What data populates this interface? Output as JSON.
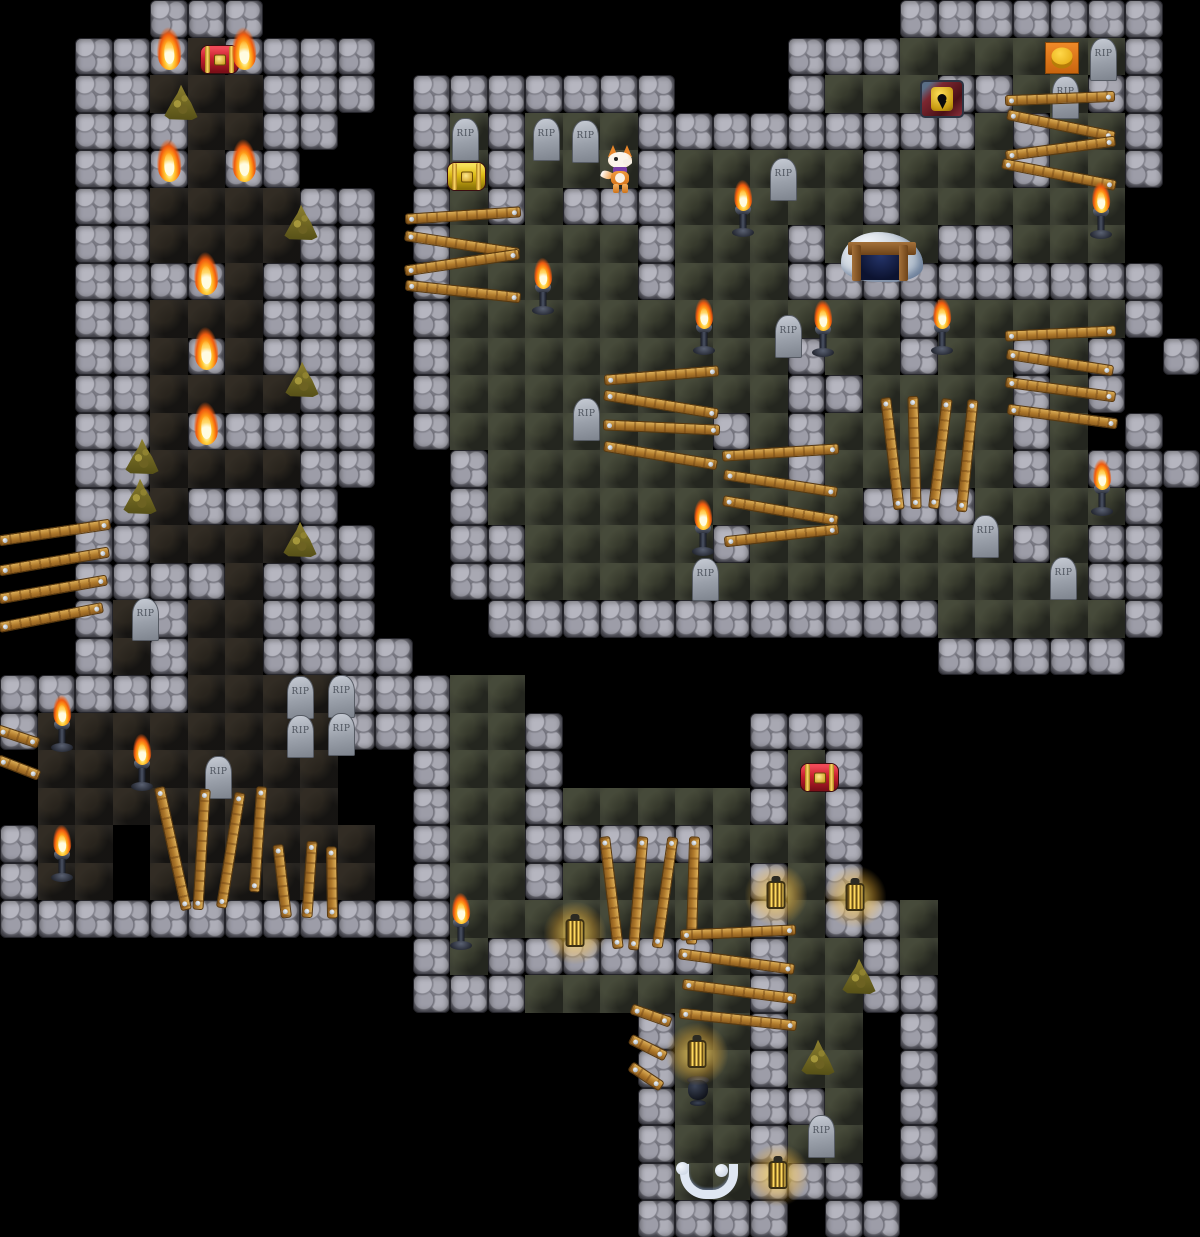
{
  "game": {
    "tile_size": 37.5,
    "grid_cols": 32,
    "grid_rows": 33,
    "labels": {
      "gravestone_text": "RIP"
    },
    "colors": {
      "background": "#000000",
      "stone_light": "#b6b6c0",
      "stone_dark": "#5a5a64",
      "floor_dark": "#272420",
      "floor_olive": "#3c3f33",
      "wood": "#b07a2c",
      "flame_orange": "#ff9a18",
      "gold": "#ffd84a",
      "chest_red": "#c81f2e",
      "chest_yellow": "#ddbb16",
      "lantern_glow": "#ffd65c"
    },
    "legend": {
      ".": "void",
      "#": "stone-wall",
      "a": "floor-dark",
      "b": "floor-olive",
      "T": "stone-wall-with-torch"
    },
    "map_rows": [
      "....###.................#######.",
      "..##TaT###...........###bbbbbb#.",
      "..##aaa###.#######...#bbb##bb##.",
      "..###aa##..#b#bbb#########b#bb#.",
      "..##TaT#...#b#bbb#bbbbb#bbb#bb#.",
      "..##aaaa##.#b#b###bbbbb#bbbbbb..",
      "..##aaaa##.#bbbbb#bbb#bbb##bbb..",
      "..###Ta###.#bbbbb#bbb##########.",
      "..##aaa###.#bbbbbbbbbbbb#bbbbb#.",
      "..##aTa###.#bbbbbbbbb#bb#bb#b#.#",
      "..##aaaa##.#bbbbbbbbb##bbbb#b#..",
      "..##aT####.#bbbbbbb#b#bbbbb#b.#.",
      "..##aaaa##..#bbbbbbbb#bbbbb#b###",
      "..##a####...#bbbbbbbbbb###bbbb#.",
      "..##aaaa##..##bbbbb#bbbbbbb#b##.",
      "..####a###..##bbbbbbbbbbbbbbb##.",
      "..#a#aa###...############bbbbb#.",
      "..#a#aa####..............#####..",
      "#####aaaa###bb..................",
      "#aaaaaaaa###bb#.....###.........",
      ".aaaaaaaa..#bb#.....#b#.........",
      ".aaaaaaaa..#bb#bbbbb#b#.........",
      "#aa.aaaaaa.#bb#####bbb#.........",
      "#aa.aaaaaa.#bb#bbbbb#b#.........",
      "############bbbbbbbb#b##b.......",
      "...........#b######b#bb#b.......",
      "...........###bbbbbb#bb##.......",
      ".................#bb#bb.#.......",
      ".................#bb#bb.#.......",
      ".................#bb##b.#.......",
      ".................#bb#bb.#.......",
      ".................#bb###.#.......",
      ".................####.##........"
    ],
    "objects": {
      "standing_torches": [
        [
          543,
          257
        ],
        [
          743,
          179
        ],
        [
          1101,
          181
        ],
        [
          1102,
          458
        ],
        [
          704,
          297
        ],
        [
          942,
          297
        ],
        [
          823,
          299
        ],
        [
          62,
          694
        ],
        [
          142,
          733
        ],
        [
          62,
          824
        ],
        [
          461,
          892
        ],
        [
          703,
          498
        ]
      ],
      "lanterns": [
        [
          565,
          918
        ],
        [
          766,
          880
        ],
        [
          845,
          882
        ],
        [
          687,
          1039
        ],
        [
          768,
          1160
        ]
      ],
      "urn": [
        686,
        1076
      ],
      "gold_piles": [
        [
          163,
          84
        ],
        [
          283,
          204
        ],
        [
          124,
          438
        ],
        [
          122,
          478
        ],
        [
          282,
          521
        ],
        [
          284,
          361
        ],
        [
          841,
          958
        ],
        [
          800,
          1039
        ]
      ],
      "gravestones": [
        [
          452,
          118
        ],
        [
          533,
          118
        ],
        [
          572,
          120
        ],
        [
          770,
          158
        ],
        [
          1090,
          38
        ],
        [
          1052,
          76
        ],
        [
          775,
          315
        ],
        [
          573,
          398
        ],
        [
          692,
          558
        ],
        [
          972,
          515
        ],
        [
          1050,
          557
        ],
        [
          132,
          598
        ],
        [
          287,
          676
        ],
        [
          328,
          675
        ],
        [
          287,
          715
        ],
        [
          328,
          713
        ],
        [
          205,
          756
        ],
        [
          808,
          1115
        ]
      ],
      "big_gravestone_index": 16,
      "red_chests": [
        [
          200,
          45
        ],
        [
          800,
          763
        ]
      ],
      "yellow_chests": [
        [
          447,
          162
        ]
      ],
      "door_lock": [
        920,
        80
      ],
      "pressure_pad": [
        1045,
        42
      ],
      "cave_entrance": [
        841,
        232
      ],
      "character": [
        605,
        145
      ],
      "bones": [
        676,
        1164
      ],
      "planks": [
        [
          408,
          219,
          518,
          212
        ],
        [
          408,
          236,
          517,
          253
        ],
        [
          408,
          270,
          517,
          254
        ],
        [
          408,
          285,
          517,
          297
        ],
        [
          1008,
          100,
          1112,
          96
        ],
        [
          1010,
          115,
          1112,
          136
        ],
        [
          1008,
          155,
          1112,
          141
        ],
        [
          1005,
          164,
          1113,
          185
        ],
        [
          607,
          380,
          716,
          371
        ],
        [
          607,
          395,
          716,
          413
        ],
        [
          606,
          425,
          717,
          430
        ],
        [
          607,
          446,
          715,
          464
        ],
        [
          725,
          456,
          836,
          449
        ],
        [
          727,
          475,
          835,
          492
        ],
        [
          726,
          501,
          835,
          520
        ],
        [
          727,
          541,
          835,
          529
        ],
        [
          886,
          400,
          899,
          506
        ],
        [
          913,
          399,
          916,
          506
        ],
        [
          947,
          401,
          934,
          505
        ],
        [
          973,
          402,
          962,
          508
        ],
        [
          1008,
          336,
          1113,
          331
        ],
        [
          1010,
          354,
          1111,
          370
        ],
        [
          1008,
          382,
          1112,
          396
        ],
        [
          1010,
          409,
          1114,
          423
        ],
        [
          160,
          790,
          186,
          907
        ],
        [
          205,
          792,
          198,
          907
        ],
        [
          240,
          795,
          222,
          905
        ],
        [
          262,
          789,
          255,
          889
        ],
        [
          278,
          847,
          286,
          915
        ],
        [
          312,
          844,
          307,
          915
        ],
        [
          332,
          849,
          333,
          915
        ],
        [
          605,
          839,
          618,
          945
        ],
        [
          643,
          839,
          634,
          947
        ],
        [
          673,
          840,
          658,
          945
        ],
        [
          695,
          839,
          692,
          941
        ],
        [
          683,
          935,
          793,
          930
        ],
        [
          682,
          954,
          792,
          969
        ],
        [
          685,
          984,
          793,
          998
        ],
        [
          682,
          1013,
          793,
          1025
        ],
        [
          634,
          1009,
          668,
          1021
        ],
        [
          633,
          1040,
          663,
          1055
        ],
        [
          633,
          1067,
          660,
          1085
        ],
        [
          2,
          540,
          108,
          524
        ],
        [
          2,
          570,
          106,
          552
        ],
        [
          2,
          598,
          104,
          580
        ],
        [
          2,
          627,
          100,
          608
        ],
        [
          0,
          730,
          36,
          742
        ],
        [
          0,
          760,
          36,
          774
        ]
      ]
    }
  }
}
